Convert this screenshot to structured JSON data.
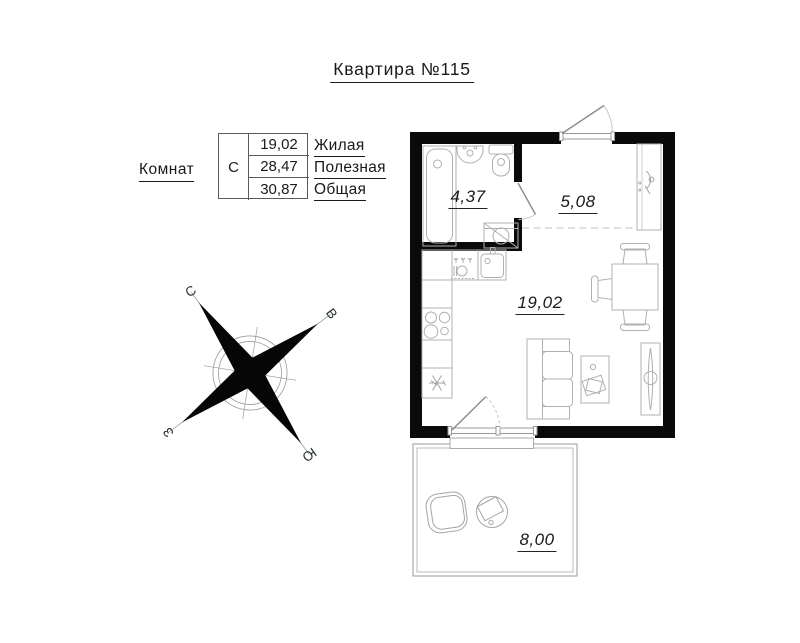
{
  "title": "Квартира №115",
  "legend": {
    "rooms_label": "Комнат",
    "rooms_count": "С",
    "areas": [
      {
        "value": "19,02",
        "label": "Жилая"
      },
      {
        "value": "28,47",
        "label": "Полезная"
      },
      {
        "value": "30,87",
        "label": "Общая"
      }
    ]
  },
  "compass": {
    "north": "С",
    "east": "В",
    "west": "З",
    "south": "Ю"
  },
  "floorplan": {
    "rooms": [
      {
        "id": "bathroom",
        "area": "4,37"
      },
      {
        "id": "hallway",
        "area": "5,08"
      },
      {
        "id": "living-room",
        "area": "19,02"
      },
      {
        "id": "balcony",
        "area": "8,00"
      }
    ]
  },
  "colors": {
    "wall": "#0a0a0a",
    "furniture_line": "#b0b0b0",
    "text": "#1a1a1a"
  }
}
